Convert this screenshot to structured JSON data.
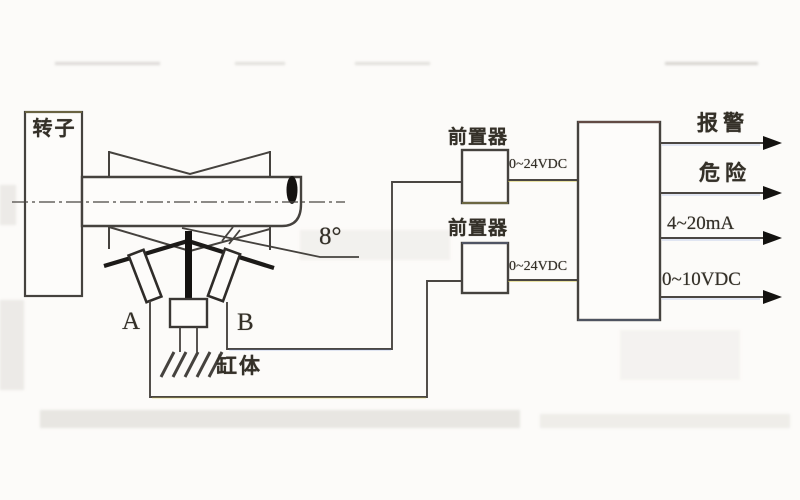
{
  "diagram": {
    "rotor_label": "转子",
    "sensor_a_label": "A",
    "sensor_b_label": "B",
    "cylinder_label": "缸体",
    "angle_label": "8°",
    "preamp1_label": "前置器",
    "preamp2_label": "前置器",
    "preamp1_supply": "0~24VDC",
    "preamp2_supply": "0~24VDC",
    "outputs": [
      "报警",
      "危险",
      "4~20mA",
      "0~10VDC"
    ]
  },
  "colors": {
    "line": "#3f3c38",
    "ink": "#343028",
    "background": "#fcfbf9",
    "fringe_yellow": "#d6c94f",
    "fringe_blue": "#6f8fd8",
    "fringe_red": "#c96a5a"
  }
}
